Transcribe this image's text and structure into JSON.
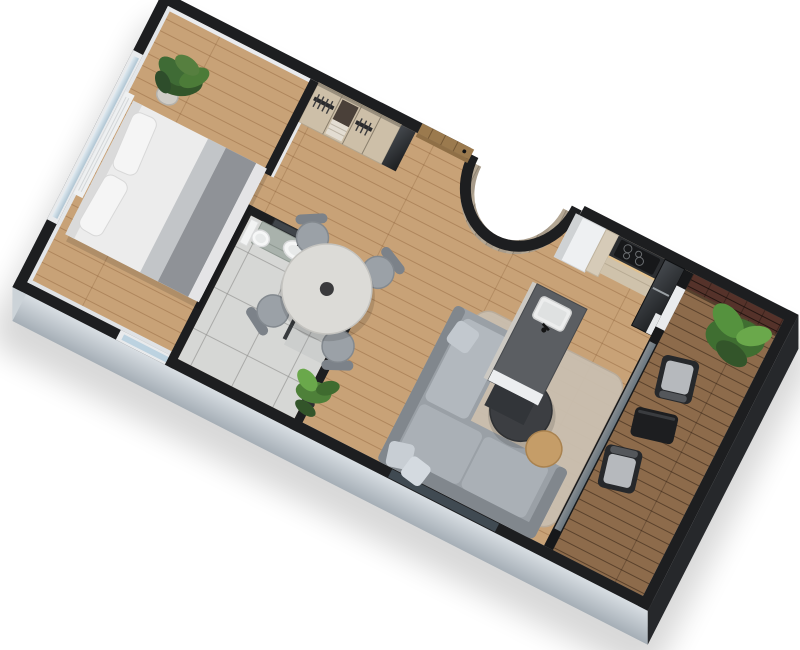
{
  "scene": {
    "type": "3d-floor-plan-render",
    "view": "rotated axonometric top-down cutaway",
    "background": "white",
    "rooms": [
      {
        "name": "bedroom",
        "furniture": [
          "double bed with grey runner",
          "potted plant",
          "radiator",
          "window wall"
        ]
      },
      {
        "name": "hallway",
        "furniture": [
          "open wardrobe with hangers",
          "dresser niche",
          "grey mirror panel",
          "wood entry door"
        ]
      },
      {
        "name": "bathroom",
        "furniture": [
          "vanity with vessel sink",
          "mirror",
          "toilet",
          "glass shower screen"
        ]
      },
      {
        "name": "dining-area",
        "furniture": [
          "round table",
          "four grey chairs",
          "floor plant",
          "curved wood partition"
        ]
      },
      {
        "name": "kitchen",
        "furniture": [
          "tall fridge cabinet",
          "counter with induction cooktop",
          "dark oven column",
          "island with sink"
        ]
      },
      {
        "name": "living-area",
        "furniture": [
          "grey chaise sofa",
          "dark round coffee table",
          "oak side table",
          "beige rug"
        ]
      },
      {
        "name": "balcony",
        "furniture": [
          "wood deck",
          "brick wall",
          "two lounge chairs",
          "black coffee table",
          "planter with plant"
        ]
      }
    ],
    "colors": {
      "wall": "#1d1e20",
      "wall_inner": "#e9ebee",
      "facade": "#b9c1c9",
      "facade_light": "#ccd3d8",
      "floor": "#c8a277",
      "deck": "#8d6b4b",
      "tile": "#d6d7d5",
      "brick": "#55322a",
      "curve_wood": "#b4a794",
      "bed": "#ececec",
      "bed_runner": "#8f9297",
      "sofa": "#9aa0a6",
      "cushion": "#b2b8be",
      "rug": "#cabfb0",
      "dining_table": "#dcdbd7",
      "chair": "#9ba1a7",
      "island": "#5b5e62",
      "counter": "#2c2e31",
      "cabinet": "#cfc2ab",
      "fridge": "#eef0f2",
      "door_wood": "#9b7a4e",
      "plant": "#4c7b38",
      "plant_light": "#6aa84b",
      "glass": "#bcd2e0",
      "outdoor": "#26282b",
      "shadow": "#000000"
    }
  }
}
